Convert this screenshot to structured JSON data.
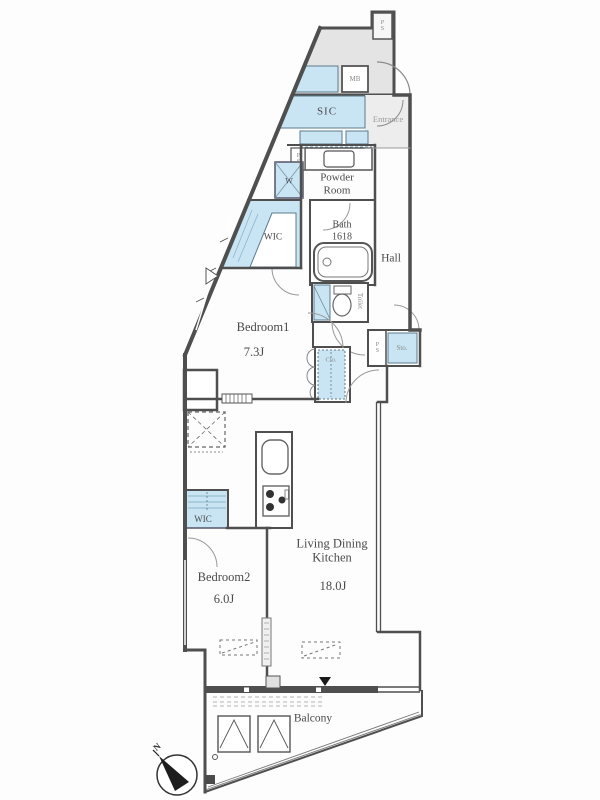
{
  "plan": {
    "rooms": {
      "bedroom1": {
        "name": "Bedroom1",
        "size": "7.3J"
      },
      "bedroom2": {
        "name": "Bedroom2",
        "size": "6.0J"
      },
      "ldk": {
        "name": "Living Dining Kitchen",
        "size": "18.0J"
      },
      "balcony": {
        "name": "Balcony"
      },
      "hall": {
        "name": "Hall"
      },
      "powder_room": {
        "name": "Powder Room"
      },
      "bath": {
        "name": "Bath",
        "size": "1618"
      },
      "entrance": {
        "name": "Entrance"
      },
      "toilet": {
        "name": "Toilet"
      }
    },
    "storage": {
      "sic": "SIC",
      "wic1": "WIC",
      "wic2": "WIC",
      "closet": "Clo.",
      "storage": "Sto.",
      "washer": "W"
    },
    "utility": {
      "meter_box": "MB",
      "pipe_space": "PS"
    },
    "compass": {
      "north": "N"
    },
    "colors": {
      "storage_fill": "#c9e5f3",
      "common_area_fill": "#e4e4e4",
      "wall": "#4f4f4f",
      "label_text": "#4a4a4a",
      "muted_text": "#8a8a8a"
    }
  }
}
